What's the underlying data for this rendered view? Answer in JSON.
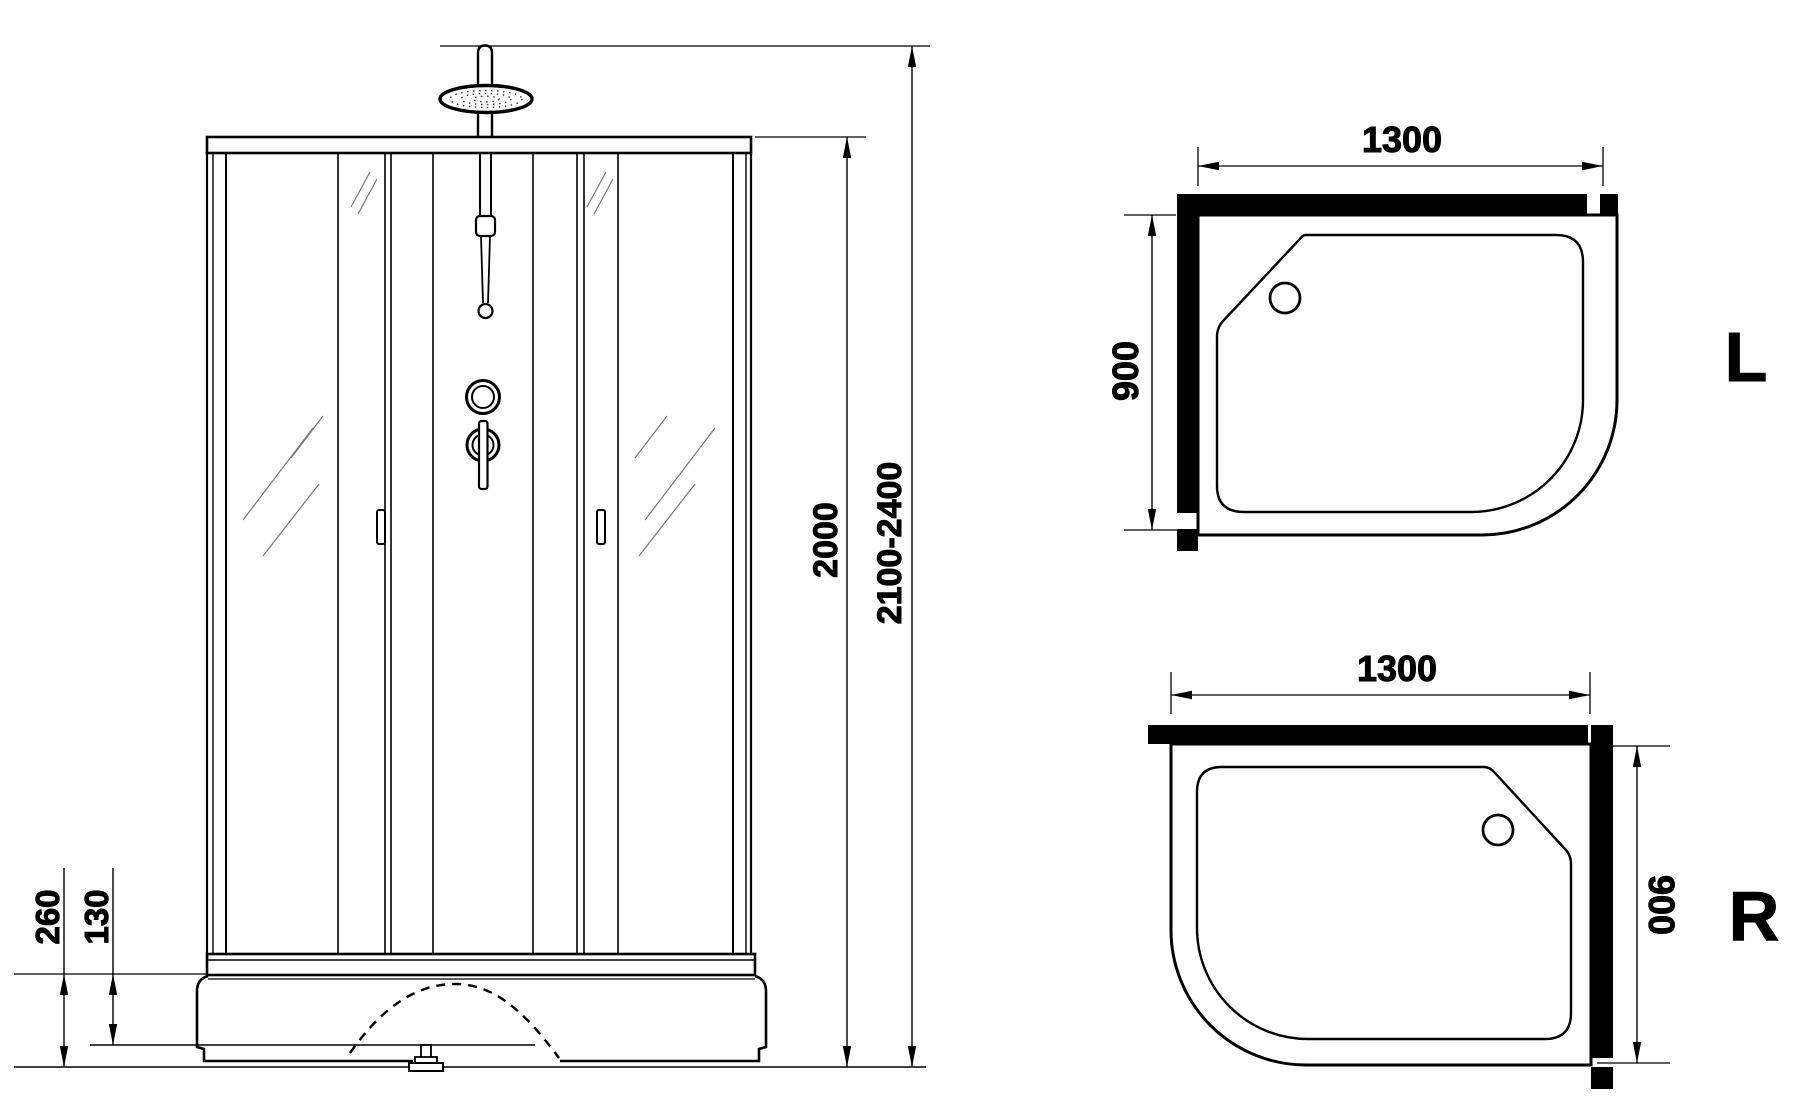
{
  "drawing_title": "shower-cabin-technical-drawing",
  "colors": {
    "line": "#000000",
    "background": "#ffffff",
    "reflection": "#777777"
  },
  "front_view": {
    "dims": {
      "tray_height": "260",
      "tray_inner_height": "130",
      "cabin_height": "2000",
      "total_height": "2100-2400"
    }
  },
  "plan_views": {
    "left": {
      "label": "L",
      "width": "1300",
      "depth": "900"
    },
    "right": {
      "label": "R",
      "width": "1300",
      "depth": "900"
    }
  },
  "icons": {
    "shower_head": "shower-head-icon",
    "hand_shower": "hand-shower-icon",
    "drain": "drain-icon",
    "foot": "adjustable-foot-icon"
  }
}
